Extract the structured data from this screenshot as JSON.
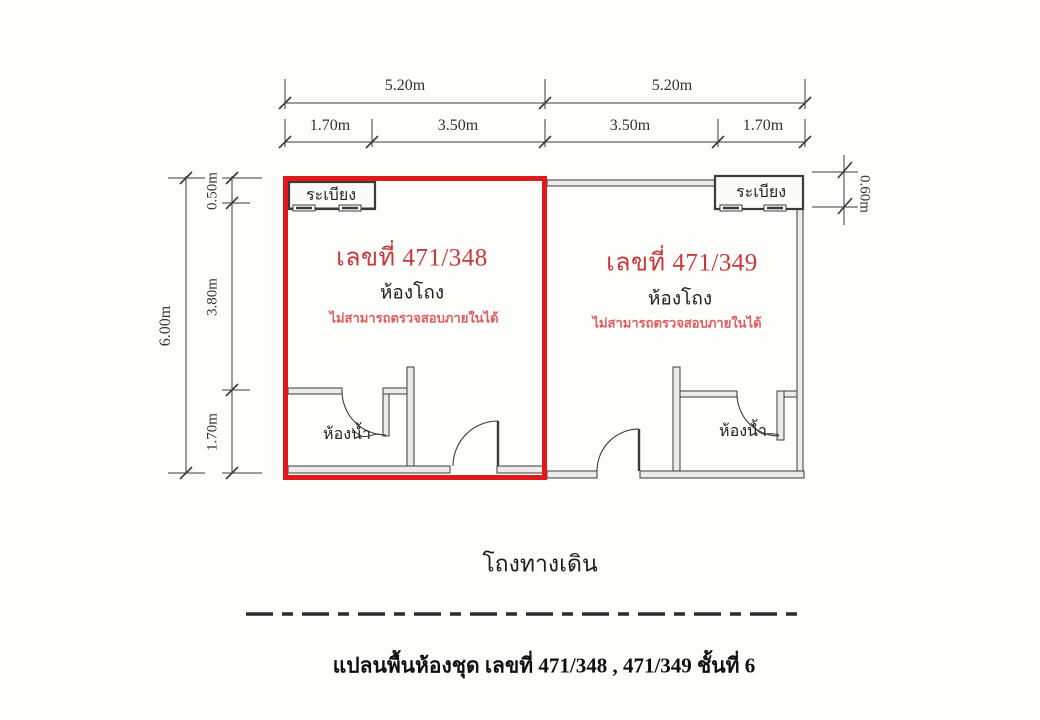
{
  "plan": {
    "caption": "แปลนพื้นห้องชุด  เลขที่ 471/348 , 471/349 ชั้นที่ 6",
    "corridor_label": "โถงทางเดิน",
    "units": [
      {
        "number": "เลขที่ 471/348",
        "hall_label": "ห้องโถง",
        "note": "ไม่สามารถตรวจสอบภายในได้",
        "balcony_label": "ระเบียง",
        "bathroom_label": "ห้องน้ำ",
        "highlighted": true
      },
      {
        "number": "เลขที่ 471/349",
        "hall_label": "ห้องโถง",
        "note": "ไม่สามารถตรวจสอบภายในได้",
        "balcony_label": "ระเบียง",
        "bathroom_label": "ห้องน้ำ",
        "highlighted": false
      }
    ],
    "dimensions": {
      "top_overall": [
        "5.20m",
        "5.20m"
      ],
      "top_segments": [
        "1.70m",
        "3.50m",
        "3.50m",
        "1.70m"
      ],
      "left_overall": "6.00m",
      "left_segments": [
        "0.50m",
        "3.80m",
        "1.70m"
      ],
      "right_balcony_depth": "0.60m"
    },
    "colors": {
      "highlight_outline": "#e01a1a",
      "unit_number_text": "#c8393b",
      "note_text": "#e05c5e",
      "wall_line": "#3b3b3b"
    }
  }
}
